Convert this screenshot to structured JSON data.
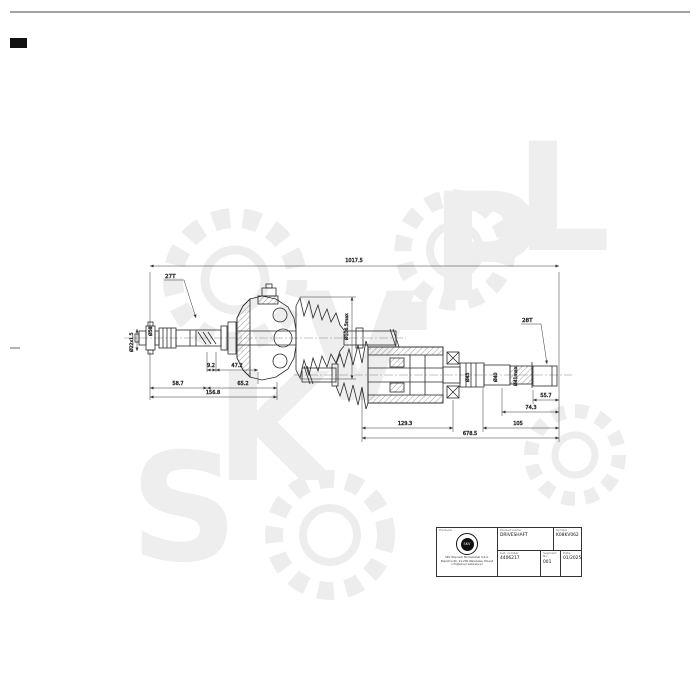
{
  "sheet": {
    "watermark_letters": [
      "S",
      "K",
      "V",
      ".",
      "P",
      "L"
    ]
  },
  "drawing": {
    "dims": {
      "overall": "1017.5",
      "left": {
        "thread": "Ø22x1.5",
        "dia_shaft": "Ø58",
        "spline": "27T",
        "d_9_2": "9.2",
        "d_47_2": "47.2",
        "d_58_7": "58.7",
        "d_65_2": "65.2",
        "d_156_8": "156.8"
      },
      "boot": {
        "max_dia": "Ø106.5max"
      },
      "right": {
        "spline": "28T",
        "d_129_3": "129.3",
        "d_678_5": "678.5",
        "d_105": "105",
        "d_74_3": "74.3",
        "d_55_7": "55.7",
        "dia_45": "Ø45",
        "dia_40": "Ø40",
        "dia_41": "Ø41max"
      }
    }
  },
  "title_block": {
    "producer_label": "Producer",
    "product_name_label": "Product name",
    "product_name": "DRIVESHAFT",
    "symbol_label": "Symbol",
    "symbol": "K08KV062",
    "cat_number_label": "Cat. number",
    "cat_number": "4406217",
    "segment_label": "Segment No.",
    "segment": "001",
    "date_label": "Date",
    "date": "01/2025",
    "logo_text": "SKV",
    "company_line1": "SKV Wojciech Michałowski S.K.A.",
    "company_line2": "Paprotna 6b, 91-200 Warszawa, Poland",
    "company_line3": "info@skv.pl  www.skv.pl"
  }
}
